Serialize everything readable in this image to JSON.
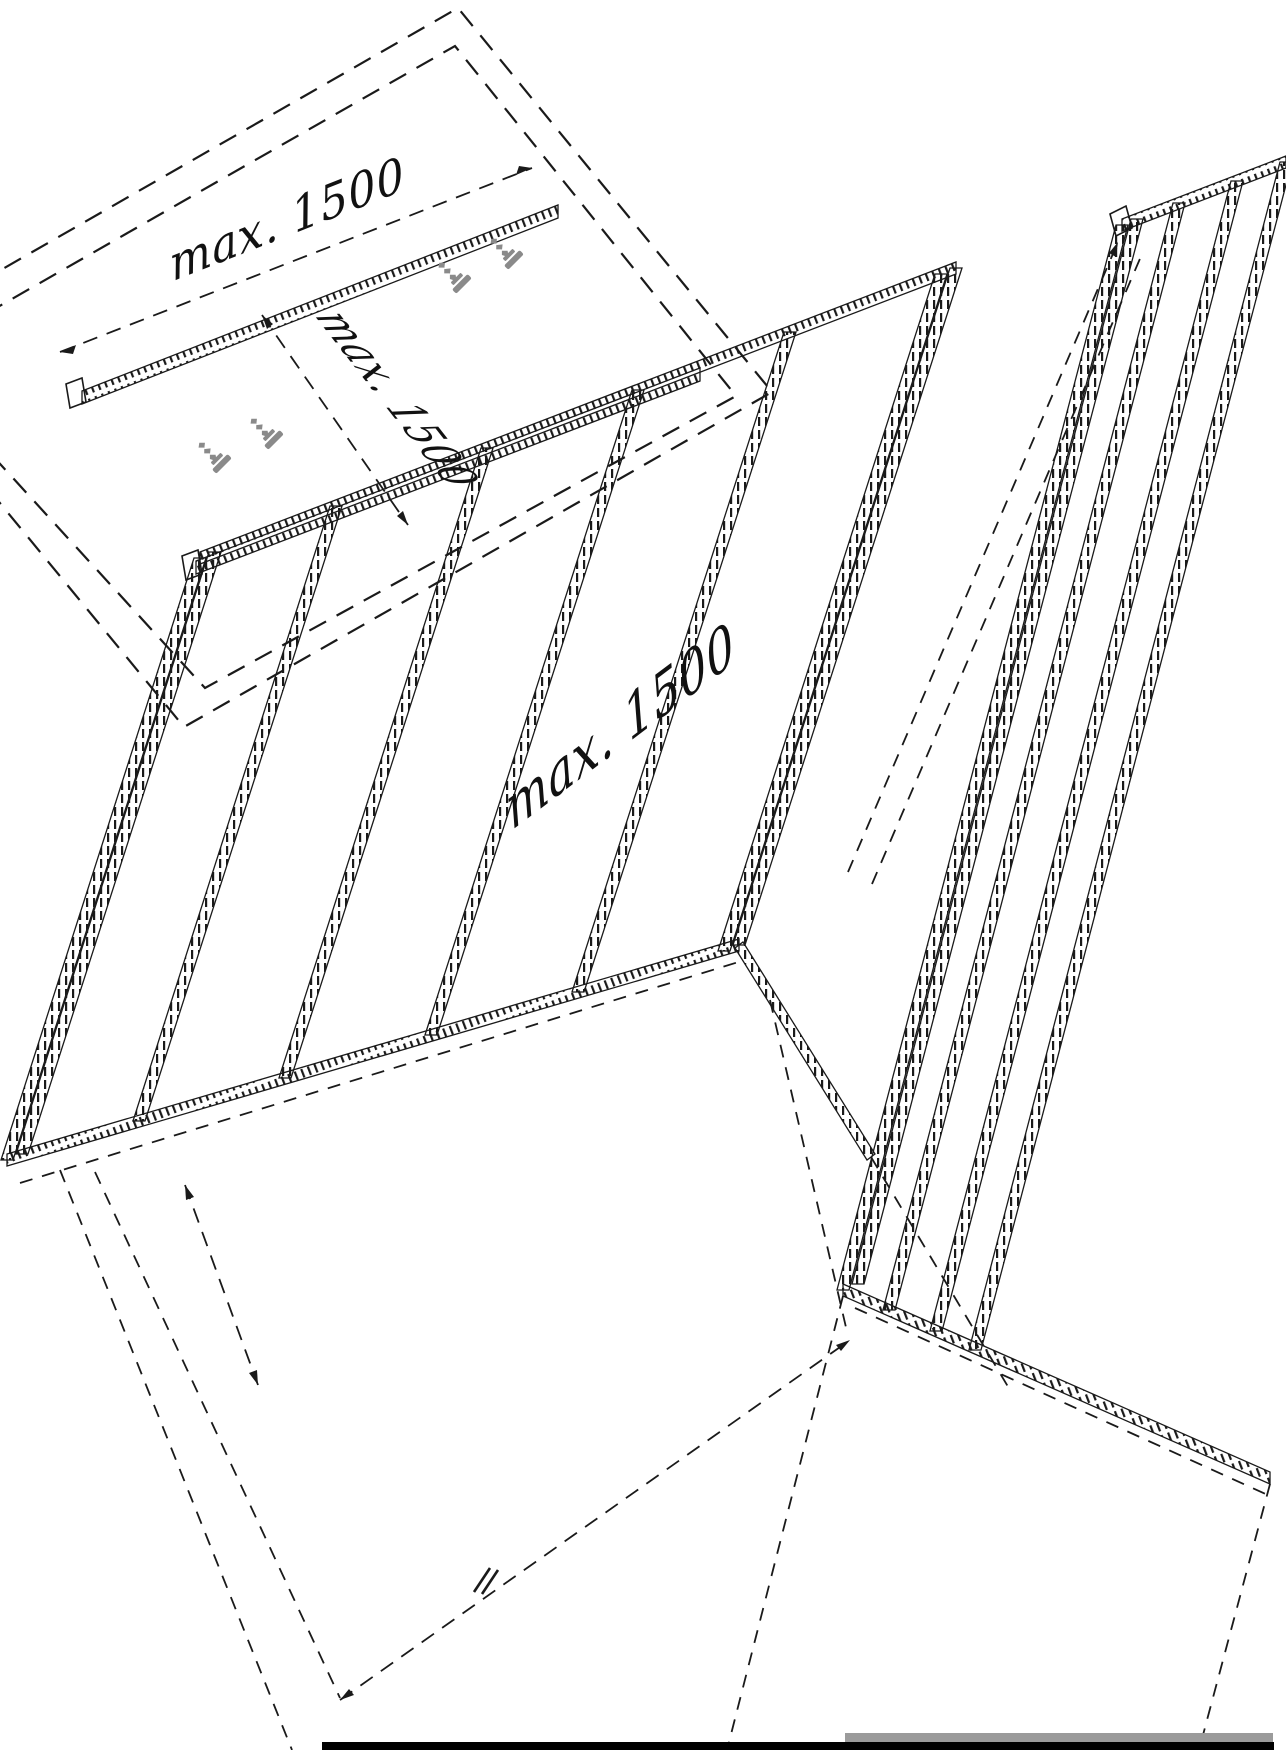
{
  "drawing": {
    "type": "isometric installation drawing of panels on support rails",
    "dimension_labels": {
      "top_span": "max. 1500",
      "side_span": "max. 1500",
      "panel_span": "max. 1500"
    },
    "colors": {
      "background": "#ffffff",
      "line": "#1a1a1a",
      "screw_gray": "#8a8a8a",
      "bottom_bar_black": "#000000",
      "bottom_bar_gray": "#9b9b9b"
    },
    "icons": [
      "screw-icon",
      "dimension-arrowhead",
      "dimension-tick"
    ]
  }
}
